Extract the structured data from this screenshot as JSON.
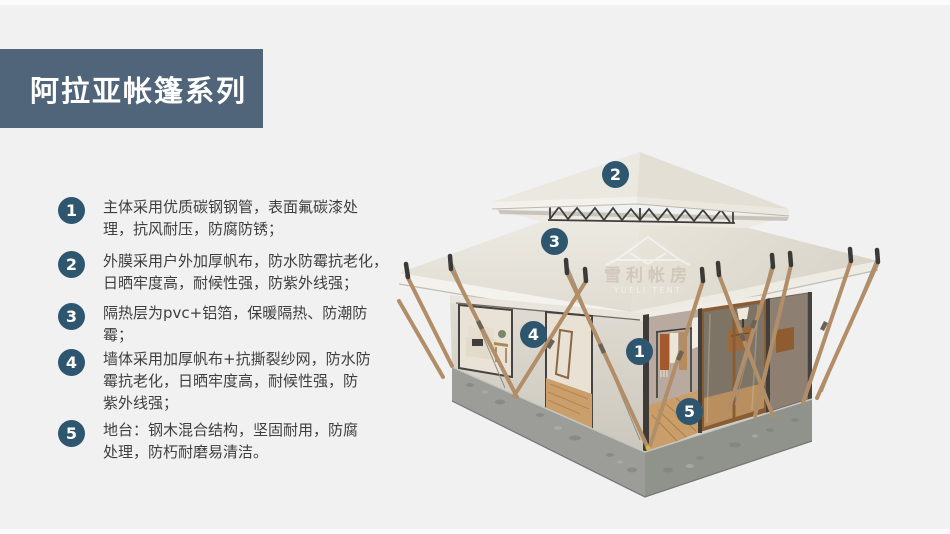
{
  "page": {
    "background": "#f1f1f2"
  },
  "colors": {
    "page-bg": "#f1f1f2",
    "banner": "#50657a",
    "badge": "#2f566f",
    "text": "#3e3e3e"
  },
  "header": {
    "title": "阿拉亚帐篷系列"
  },
  "features": [
    {
      "num": "1",
      "text": "主体采用优质碳钢钢管，表面氟碳漆处\n理，抗风耐压，防腐防锈；"
    },
    {
      "num": "2",
      "text": "外膜采用户外加厚帆布，防水防霉抗老化，\n日晒牢度高，耐候性强，防紫外线强；"
    },
    {
      "num": "3",
      "text": "隔热层为pvc+铝箔，保暖隔热、防潮防\n霉；"
    },
    {
      "num": "4",
      "text": "墙体采用加厚帆布+抗撕裂纱网，防水防\n霉抗老化，日晒牢度高，耐候性强，防\n紫外线强；"
    },
    {
      "num": "5",
      "text": "地台：钢木混合结构，坚固耐用，防腐\n处理，防朽耐磨易清洁。"
    }
  ],
  "tent": {
    "markers": [
      {
        "num": "1"
      },
      {
        "num": "2"
      },
      {
        "num": "3"
      },
      {
        "num": "4"
      },
      {
        "num": "5"
      }
    ],
    "watermark": {
      "cn": "雪利帐房",
      "en": "YUELI TENT"
    }
  }
}
